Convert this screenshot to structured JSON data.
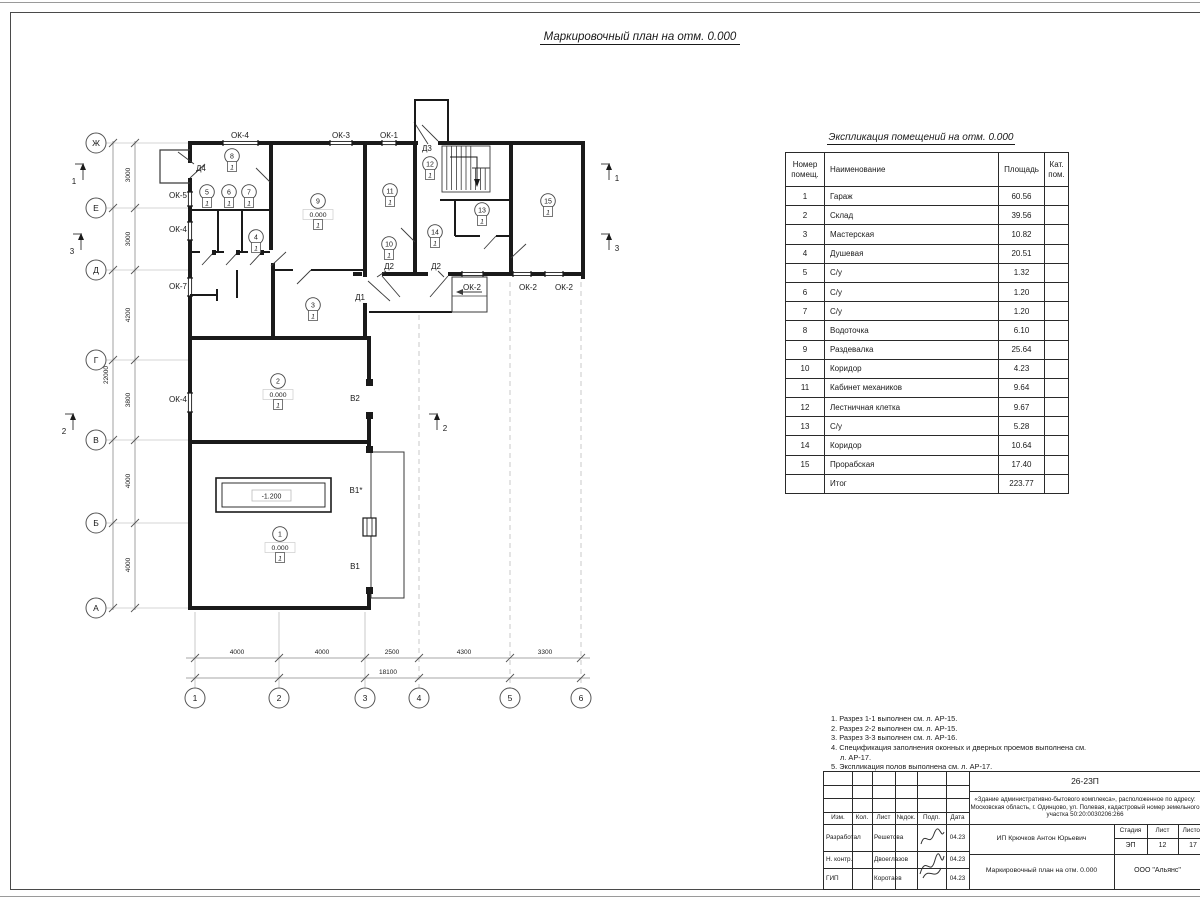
{
  "sheet": {
    "plan_title": "Маркировочный план на отм. 0.000",
    "table_title": "Экспликация помещений на отм. 0.000"
  },
  "plan": {
    "axes_rows": [
      {
        "label": "Ж",
        "y": 143
      },
      {
        "label": "Е",
        "y": 208
      },
      {
        "label": "Д",
        "y": 270
      },
      {
        "label": "Г",
        "y": 360
      },
      {
        "label": "В",
        "y": 440
      },
      {
        "label": "Б",
        "y": 523
      },
      {
        "label": "А",
        "y": 608
      }
    ],
    "axes_cols": [
      {
        "label": "1",
        "x": 195
      },
      {
        "label": "2",
        "x": 279
      },
      {
        "label": "3",
        "x": 365
      },
      {
        "label": "4",
        "x": 419
      },
      {
        "label": "5",
        "x": 510
      },
      {
        "label": "6",
        "x": 581
      }
    ],
    "dims_left": [
      {
        "v": "3000",
        "y": 175
      },
      {
        "v": "3000",
        "y": 239
      },
      {
        "v": "4200",
        "y": 315
      },
      {
        "v": "3800",
        "y": 400
      },
      {
        "v": "4000",
        "y": 481
      },
      {
        "v": "4000",
        "y": 565
      }
    ],
    "dim_left_overall": {
      "v": "22000",
      "y": 375
    },
    "dims_bottom": [
      {
        "v": "4000",
        "x": 237
      },
      {
        "v": "4000",
        "x": 322
      },
      {
        "v": "2500",
        "x": 392
      },
      {
        "v": "4300",
        "x": 464
      },
      {
        "v": "3300",
        "x": 545
      }
    ],
    "dim_bottom_overall": {
      "v": "18100",
      "x": 388
    },
    "opening_labels": [
      {
        "t": "ОК-4",
        "x": 240,
        "y": 138,
        "a": "middle"
      },
      {
        "t": "ОК-3",
        "x": 341,
        "y": 138,
        "a": "middle"
      },
      {
        "t": "ОК-1",
        "x": 389,
        "y": 138,
        "a": "middle"
      },
      {
        "t": "Д3",
        "x": 422,
        "y": 151,
        "a": "start"
      },
      {
        "t": "Д4",
        "x": 196,
        "y": 171,
        "a": "start"
      },
      {
        "t": "ОК-5",
        "x": 187,
        "y": 198,
        "a": "end"
      },
      {
        "t": "ОК-4",
        "x": 187,
        "y": 232,
        "a": "end"
      },
      {
        "t": "ОК-7",
        "x": 187,
        "y": 289,
        "a": "end"
      },
      {
        "t": "ОК-4",
        "x": 187,
        "y": 402,
        "a": "end"
      },
      {
        "t": "Д2",
        "x": 389,
        "y": 269,
        "a": "middle"
      },
      {
        "t": "Д2",
        "x": 436,
        "y": 269,
        "a": "middle"
      },
      {
        "t": "Д1",
        "x": 360,
        "y": 300,
        "a": "middle"
      },
      {
        "t": "ОК-2",
        "x": 472,
        "y": 290,
        "a": "middle"
      },
      {
        "t": "ОК-2",
        "x": 528,
        "y": 290,
        "a": "middle"
      },
      {
        "t": "ОК-2",
        "x": 564,
        "y": 290,
        "a": "middle"
      },
      {
        "t": "В2",
        "x": 355,
        "y": 401,
        "a": "middle"
      },
      {
        "t": "В1*",
        "x": 356,
        "y": 493,
        "a": "middle"
      },
      {
        "t": "В1",
        "x": 355,
        "y": 569,
        "a": "middle"
      }
    ],
    "rooms": [
      {
        "n": "8",
        "x": 232,
        "y": 156,
        "level": null,
        "floor": "1"
      },
      {
        "n": "5",
        "x": 207,
        "y": 192,
        "level": null,
        "floor": "1"
      },
      {
        "n": "6",
        "x": 229,
        "y": 192,
        "level": null,
        "floor": "1"
      },
      {
        "n": "7",
        "x": 249,
        "y": 192,
        "level": null,
        "floor": "1"
      },
      {
        "n": "9",
        "x": 318,
        "y": 201,
        "level": "0.000",
        "floor": "1"
      },
      {
        "n": "4",
        "x": 256,
        "y": 237,
        "level": null,
        "floor": "1"
      },
      {
        "n": "11",
        "x": 390,
        "y": 191,
        "level": null,
        "floor": "1"
      },
      {
        "n": "12",
        "x": 430,
        "y": 164,
        "level": null,
        "floor": "1"
      },
      {
        "n": "13",
        "x": 482,
        "y": 210,
        "level": null,
        "floor": "1"
      },
      {
        "n": "14",
        "x": 435,
        "y": 232,
        "level": null,
        "floor": "1"
      },
      {
        "n": "15",
        "x": 548,
        "y": 201,
        "level": null,
        "floor": "1"
      },
      {
        "n": "10",
        "x": 389,
        "y": 244,
        "level": null,
        "floor": "1"
      },
      {
        "n": "3",
        "x": 313,
        "y": 305,
        "level": null,
        "floor": "1"
      },
      {
        "n": "2",
        "x": 278,
        "y": 381,
        "level": "0.000",
        "floor": "1"
      },
      {
        "n": "1",
        "x": 280,
        "y": 534,
        "level": "0.000",
        "floor": "1"
      }
    ],
    "pit_level": "-1.200",
    "sections": [
      {
        "n": "1",
        "x": 83,
        "y1": 162,
        "y2": 180,
        "tx": 74,
        "ty": 184
      },
      {
        "n": "3",
        "x": 81,
        "y1": 232,
        "y2": 250,
        "tx": 72,
        "ty": 254
      },
      {
        "n": "2",
        "x": 73,
        "y1": 412,
        "y2": 430,
        "tx": 64,
        "ty": 434
      },
      {
        "n": "1",
        "x": 609,
        "y1": 162,
        "y2": 180,
        "tx": 617,
        "ty": 181
      },
      {
        "n": "3",
        "x": 609,
        "y1": 232,
        "y2": 250,
        "tx": 617,
        "ty": 251
      },
      {
        "n": "2",
        "x": 437,
        "y1": 412,
        "y2": 430,
        "tx": 445,
        "ty": 431
      }
    ]
  },
  "table": {
    "headers": [
      "Номер\nпомещ.",
      "Наименование",
      "Площадь",
      "Кат.\nпом."
    ],
    "rows": [
      [
        "1",
        "Гараж",
        "60.56",
        ""
      ],
      [
        "2",
        "Склад",
        "39.56",
        ""
      ],
      [
        "3",
        "Мастерская",
        "10.82",
        ""
      ],
      [
        "4",
        "Душевая",
        "20.51",
        ""
      ],
      [
        "5",
        "С/у",
        "1.32",
        ""
      ],
      [
        "6",
        "С/у",
        "1.20",
        ""
      ],
      [
        "7",
        "С/у",
        "1.20",
        ""
      ],
      [
        "8",
        "Водоточка",
        "6.10",
        ""
      ],
      [
        "9",
        "Раздевалка",
        "25.64",
        ""
      ],
      [
        "10",
        "Коридор",
        "4.23",
        ""
      ],
      [
        "11",
        "Кабинет механиков",
        "9.64",
        ""
      ],
      [
        "12",
        "Лестничная клетка",
        "9.67",
        ""
      ],
      [
        "13",
        "С/у",
        "5.28",
        ""
      ],
      [
        "14",
        "Коридор",
        "10.64",
        ""
      ],
      [
        "15",
        "Прорабская",
        "17.40",
        ""
      ],
      [
        "",
        "Итог",
        "223.77",
        ""
      ]
    ]
  },
  "notes": {
    "lines": [
      "1. Разрез 1-1 выполнен см. л. АР-15.",
      "2. Разрез 2-2 выполнен см. л. АР-15.",
      "3. Разрез 3-3 выполнен см. л. АР-16.",
      "4. Спецификация заполнения оконных и дверных проемов выполнена см. л. АР-17.",
      "5. Экспликация полов выполнена см. л. АР-17."
    ]
  },
  "titleblock": {
    "code": "26-23П",
    "description": "«Здание административно-бытового комплекса», расположенное по адресу: Московская область, г. Одинцово, ул. Полевая, кадастровый номер земельного участка 50:20:0030206:266",
    "cols": [
      "Изм.",
      "Кол.",
      "Лист",
      "№док.",
      "Подп.",
      "Дата"
    ],
    "rows": [
      {
        "role": "Разработал",
        "name": "Решетова",
        "date": "04.23"
      },
      {
        "role": "Н. контр.",
        "name": "Двоеглазов",
        "date": "04.23"
      },
      {
        "role": "ГИП",
        "name": "Коротаев",
        "date": "04.23"
      }
    ],
    "client": "ИП Крючков Антон Юрьевич",
    "stage_label": "Стадия",
    "sheet_label": "Лист",
    "sheets_label": "Листов",
    "stage": "ЭП",
    "sheet": "12",
    "sheets": "17",
    "doc_title": "Маркировочный план на отм. 0.000",
    "company": "ООО \"Альянс\""
  }
}
